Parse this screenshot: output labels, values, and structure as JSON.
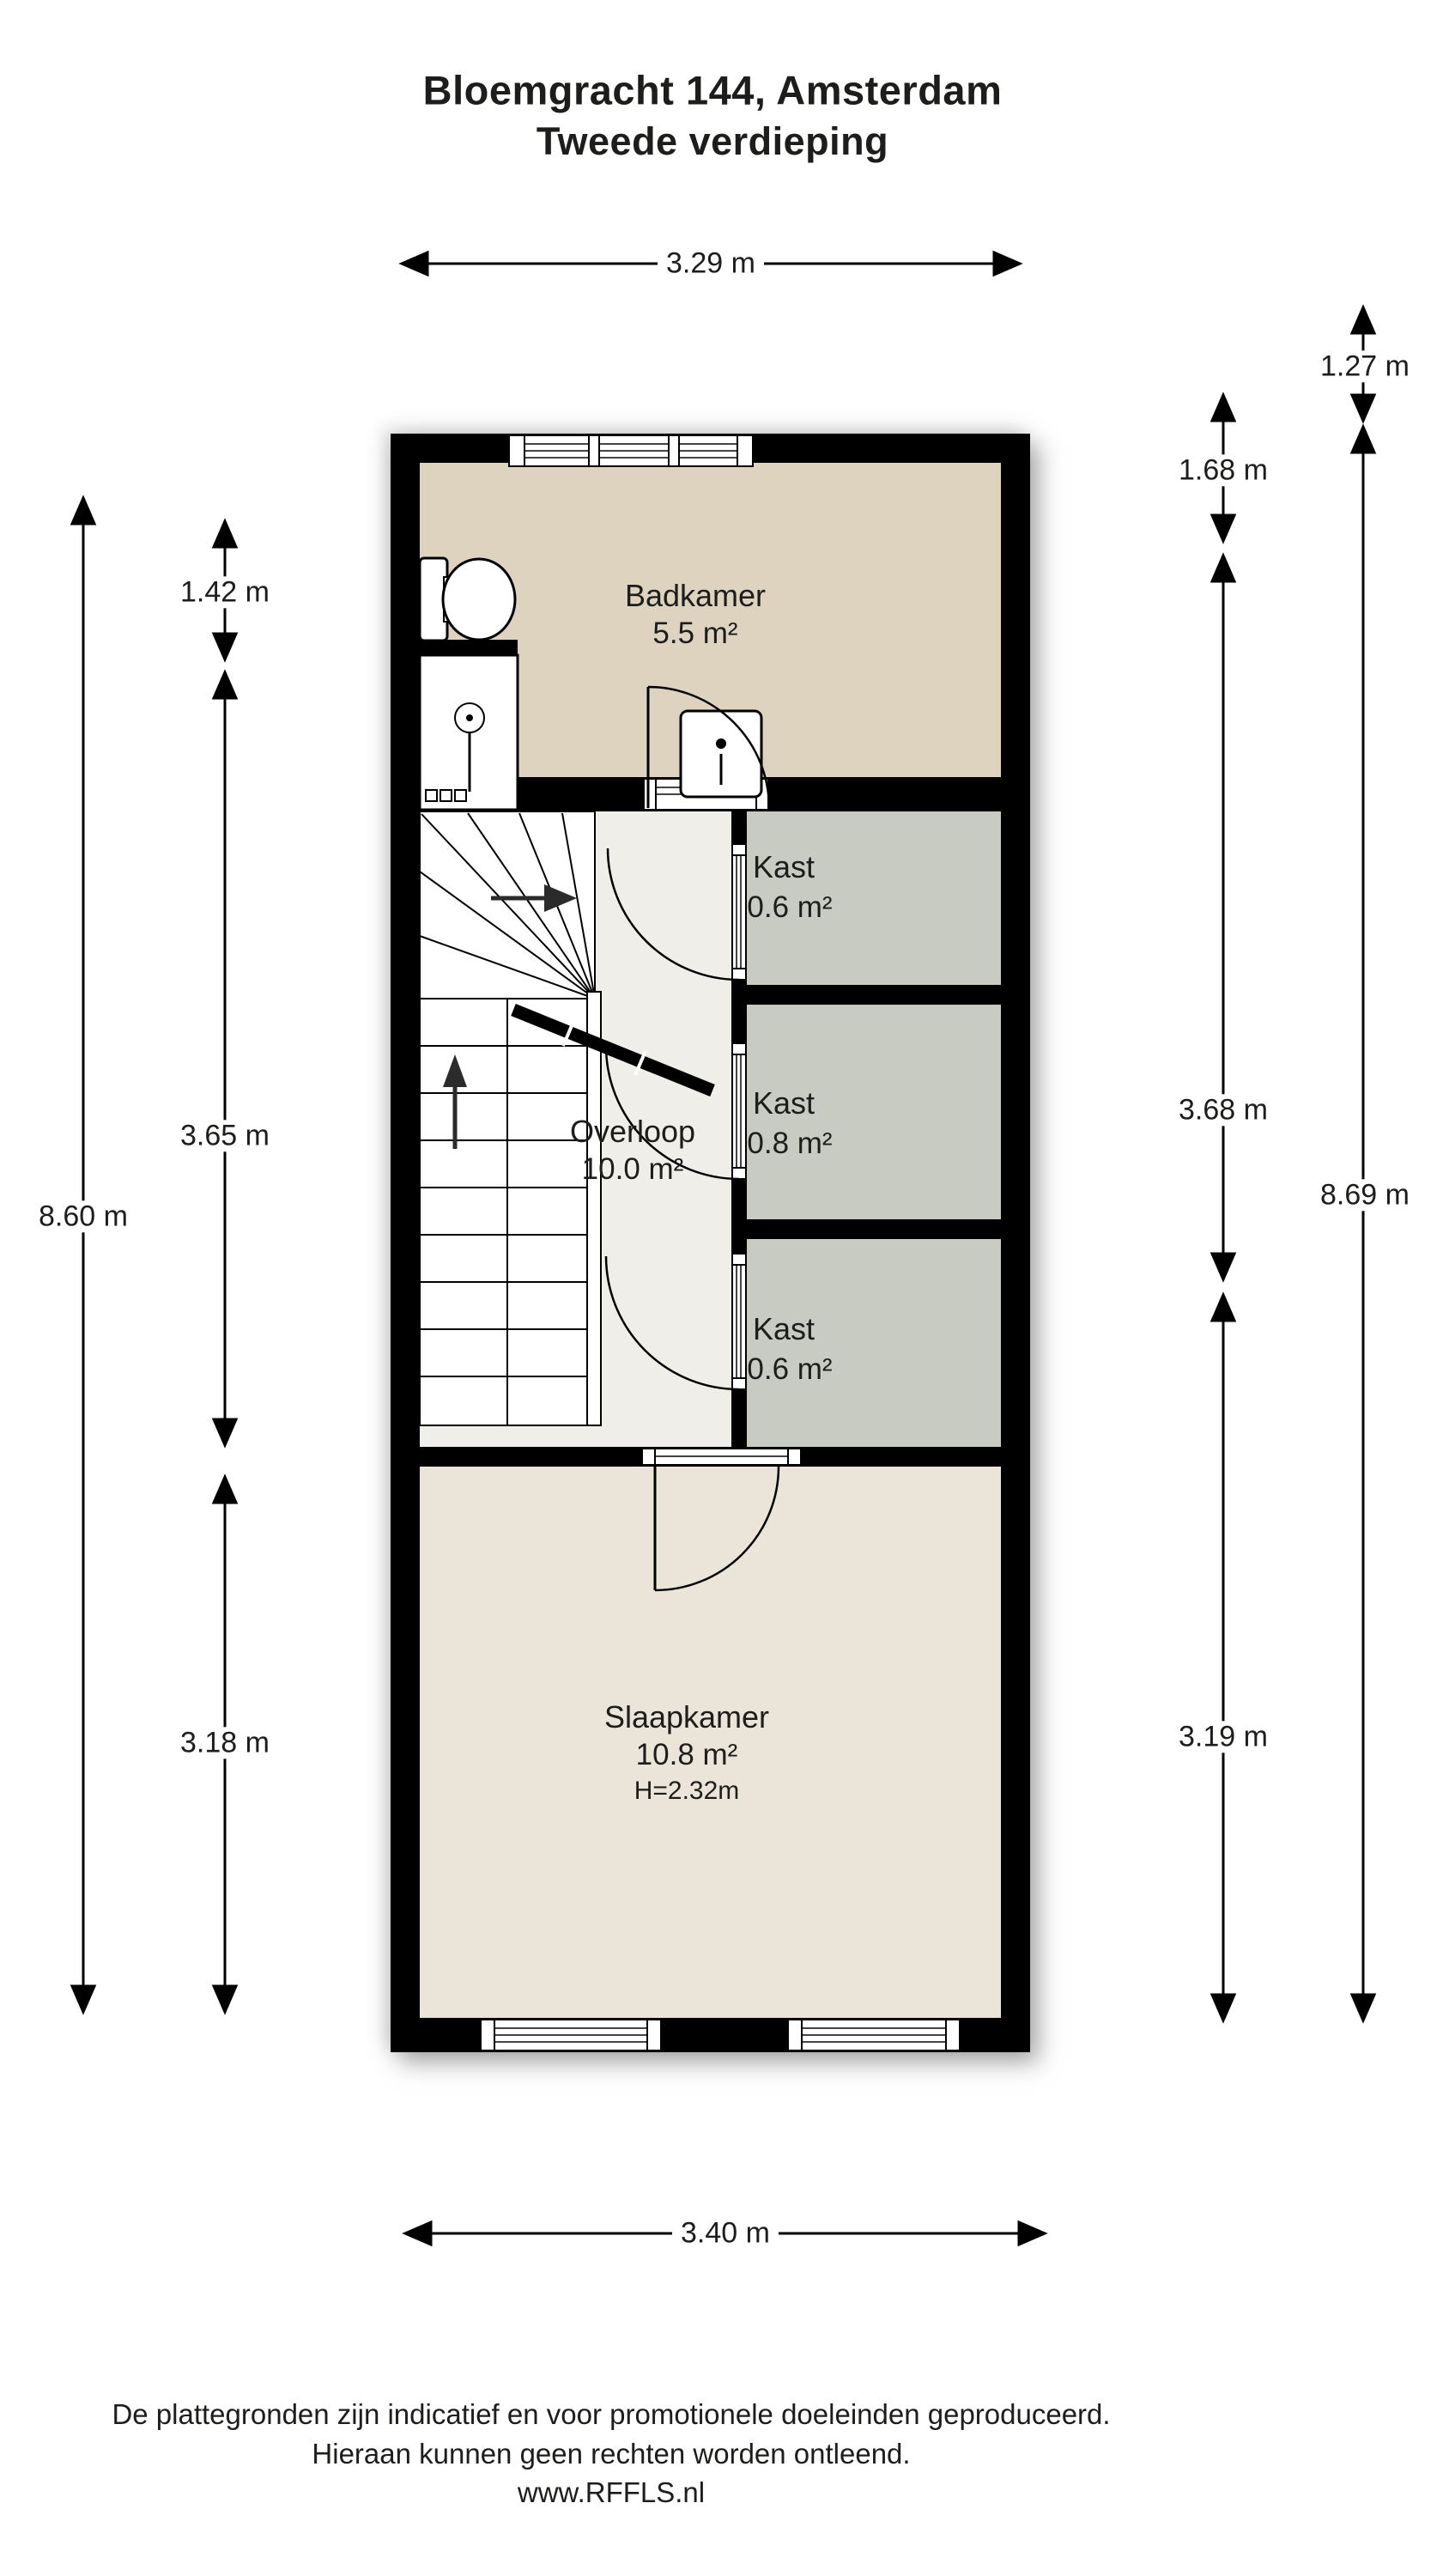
{
  "title": {
    "line1": "Bloemgracht 144, Amsterdam",
    "line2": "Tweede verdieping"
  },
  "rooms": {
    "badkamer": {
      "name": "Badkamer",
      "area": "5.5 m²"
    },
    "overloop": {
      "name": "Overloop",
      "area": "10.0 m²"
    },
    "kast1": {
      "name": "Kast",
      "area": "0.6 m²"
    },
    "kast2": {
      "name": "Kast",
      "area": "0.8 m²"
    },
    "kast3": {
      "name": "Kast",
      "area": "0.6 m²"
    },
    "slaapkamer": {
      "name": "Slaapkamer",
      "area": "10.8 m²",
      "height": "H=2.32m"
    }
  },
  "dimensions": {
    "top": "3.29 m",
    "bottom": "3.40 m",
    "left_outer": "8.60 m",
    "left_inner": [
      "1.42 m",
      "3.65 m",
      "3.18 m"
    ],
    "right_inner": [
      "1.68 m",
      "3.68 m",
      "3.19 m"
    ],
    "right_outer_top": "1.27 m",
    "right_outer": "8.69 m"
  },
  "footer": {
    "line1": "De plattegronden zijn indicatief en voor promotionele doeleinden geproduceerd.",
    "line2": "Hieraan kunnen geen rechten worden ontleend.",
    "line3": "www.RFFLS.nl"
  },
  "colors": {
    "wall": "#000000",
    "badkamer_floor": "#ddd3bf",
    "overloop_floor": "#f0eee8",
    "kast_floor": "#c7cbc2",
    "slaapkamer_floor": "#eae5d8",
    "line": "#000000"
  }
}
